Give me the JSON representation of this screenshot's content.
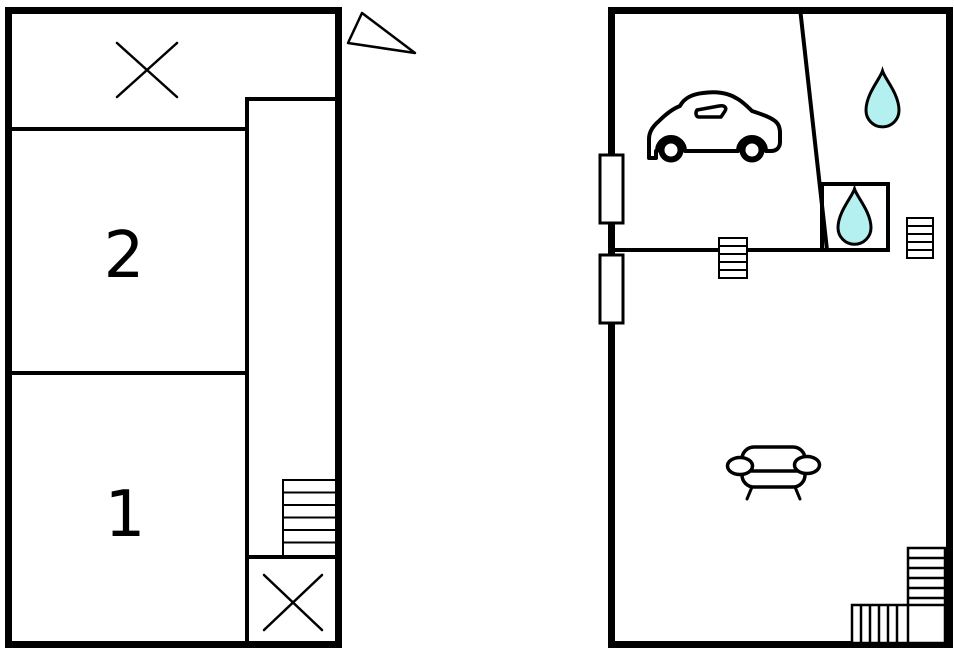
{
  "document_type": "floor-plan",
  "colors": {
    "background": "#ffffff",
    "wall": "#000000",
    "water_drop_fill": "#b5f0f0"
  },
  "left_plan": {
    "room_labels": [
      {
        "label": "2"
      },
      {
        "label": "1"
      }
    ],
    "icons": [
      "window-x-icon",
      "window-x-icon",
      "staircase-icon",
      "north-marker-icon"
    ]
  },
  "right_plan": {
    "icons": [
      "car-icon",
      "water-drop-icon",
      "water-drop-icon",
      "staircase-icon",
      "staircase-icon",
      "l-shaped-staircase-icon",
      "sofa-icon",
      "window-icon",
      "window-icon"
    ]
  }
}
